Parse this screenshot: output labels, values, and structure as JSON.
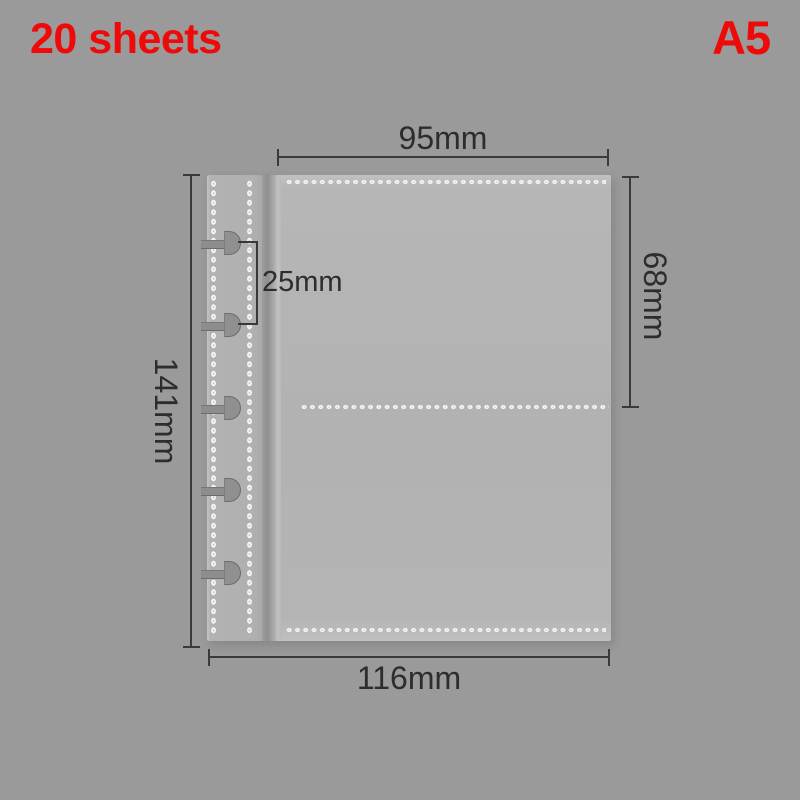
{
  "page": {
    "background_color": "#9a9a9a",
    "width": 800,
    "height": 800
  },
  "labels": {
    "sheet_count": "20 sheets",
    "size": "A5",
    "accent_color": "#ef0a0a"
  },
  "sleeve": {
    "ring_count": 5,
    "visible_pockets": 2,
    "body_color": "#b3b3b3",
    "binding_strip_color": "#b1b1b1",
    "stitch_color": "#f4f4f4",
    "ring_color": "#909090"
  },
  "dimensions": {
    "annotation_color": "#3a3a3a",
    "pocket_width": "95mm",
    "pocket_height": "68mm",
    "page_height": "141mm",
    "page_width": "116mm",
    "hole_spacing": "25mm"
  }
}
